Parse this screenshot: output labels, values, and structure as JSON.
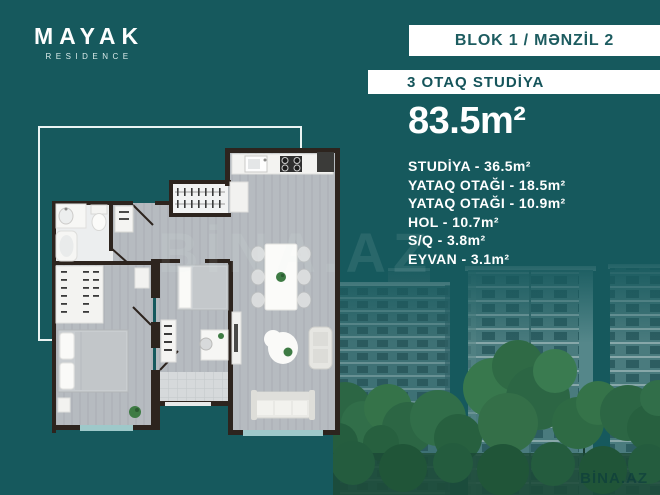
{
  "brand": {
    "name": "MAYAK",
    "tagline": "RESIDENCE"
  },
  "header": {
    "block": "BLOK 1 / MƏNZİL 2",
    "apartment_type": "3 OTAQ STUDİYA"
  },
  "details": {
    "total_area": "83.5m²",
    "rooms": [
      "STUDİYA - 36.5m²",
      "YATAQ OTAĞI - 18.5m²",
      "YATAQ OTAĞI - 10.9m²",
      "HOL - 10.7m²",
      "S/Q - 3.8m²",
      "EYVAN - 3.1m²"
    ]
  },
  "watermarks": {
    "center": "BİNA.AZ",
    "corner": "BİNA.AZ"
  },
  "colors": {
    "background": "#16595d",
    "header_text": "#1d5c60",
    "wall": "#2d241e",
    "floor": "#b6bbc0",
    "balcony": "#9ec9ca",
    "plant": "#3e7b44",
    "tree": "#2c6644"
  }
}
